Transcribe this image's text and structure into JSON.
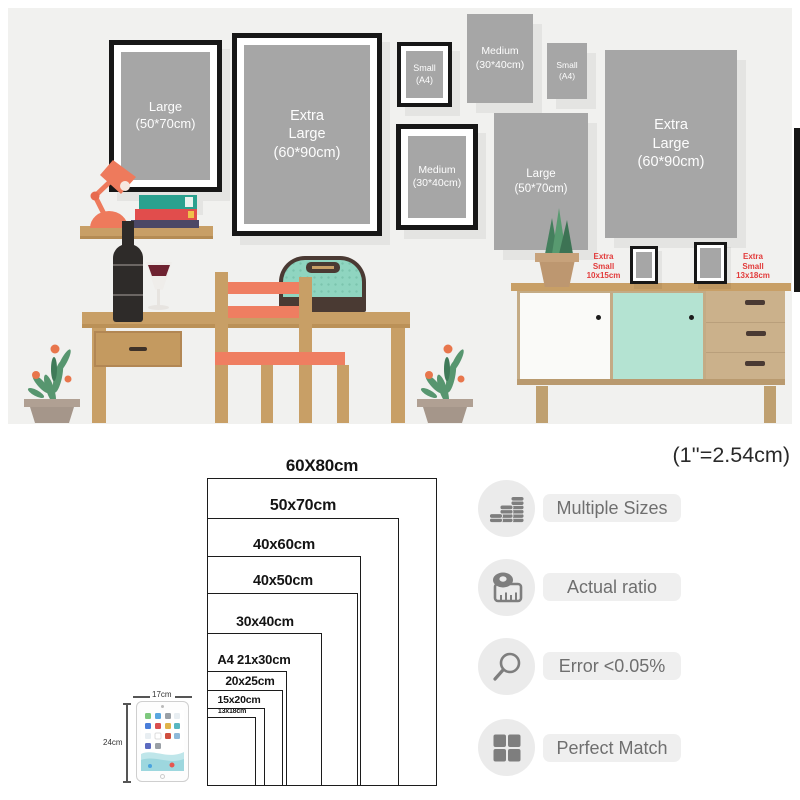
{
  "colors": {
    "scene_bg": "#f1f1ef",
    "poster_gray": "#a6a6a6",
    "frame_black": "#171717",
    "wood": "#c89f66",
    "wood_pale": "#cbb18b",
    "coral": "#ef7e61",
    "teal_bag": "#8fd5c0",
    "mint_door": "#b4e3d2",
    "dark_brown": "#4a3a33",
    "label_red": "#e23b3b",
    "icon_gray": "#7e7e7e",
    "badge_circle": "#ebebeb",
    "pill_bg": "#efefef",
    "pill_text": "#6f6f6f",
    "chart_line": "#1c1c1c"
  },
  "scene": {
    "frames": {
      "large_framed": {
        "line1": "Large",
        "line2": "(50*70cm)"
      },
      "xl_framed": {
        "line1": "Extra",
        "line2": "Large",
        "line3": "(60*90cm)"
      },
      "small_framed": {
        "line1": "Small",
        "line2": "(A4)"
      },
      "medium_framed": {
        "line1": "Medium",
        "line2": "(30*40cm)"
      },
      "medium_poster": {
        "line1": "Medium",
        "line2": "(30*40cm)"
      },
      "small_poster": {
        "line1": "Small",
        "line2": "(A4)"
      },
      "xl_poster": {
        "line1": "Extra",
        "line2": "Large",
        "line3": "(60*90cm)"
      },
      "large_poster": {
        "line1": "Large",
        "line2": "(50*70cm)"
      }
    },
    "xs_labels": {
      "left": {
        "line1": "Extra",
        "line2": "Small",
        "line3": "10x15cm"
      },
      "right": {
        "line1": "Extra",
        "line2": "Small",
        "line3": "13x18cm"
      }
    }
  },
  "size_chart": {
    "unit_note": "(1''=2.54cm)",
    "sizes": [
      {
        "label": "60X80cm",
        "w_cm": 60,
        "h_cm": 80
      },
      {
        "label": "50x70cm",
        "w_cm": 50,
        "h_cm": 70
      },
      {
        "label": "40x60cm",
        "w_cm": 40,
        "h_cm": 60
      },
      {
        "label": "40x50cm",
        "w_cm": 40,
        "h_cm": 50
      },
      {
        "label": "30x40cm",
        "w_cm": 30,
        "h_cm": 40
      },
      {
        "label": "A4  21x30cm",
        "w_cm": 21,
        "h_cm": 30
      },
      {
        "label": "20x25cm",
        "w_cm": 20,
        "h_cm": 25
      },
      {
        "label": "15x20cm",
        "w_cm": 15,
        "h_cm": 20
      },
      {
        "label": "13x18cm",
        "w_cm": 13,
        "h_cm": 18
      }
    ],
    "tablet": {
      "width_label": "17cm",
      "height_label": "24cm"
    }
  },
  "features": [
    {
      "icon": "coins-icon",
      "label": "Multiple Sizes"
    },
    {
      "icon": "tape-measure-icon",
      "label": "Actual ratio"
    },
    {
      "icon": "magnifier-icon",
      "label": "Error <0.05%"
    },
    {
      "icon": "grid-icon",
      "label": "Perfect Match"
    }
  ]
}
